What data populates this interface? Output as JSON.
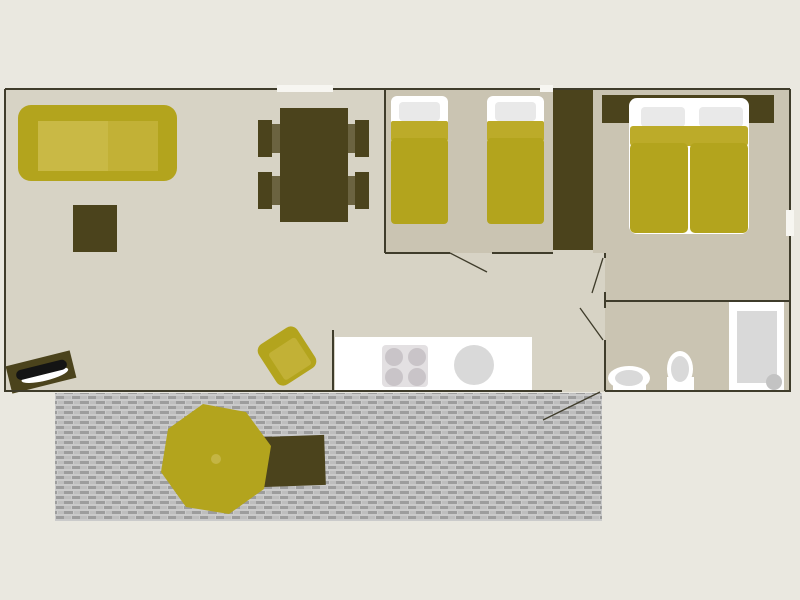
{
  "meta": {
    "title": "Mobile home floor plan (top view)",
    "style": "flat 2D architectural plan, no text labels visible"
  },
  "palette": {
    "bg": "#eae8e0",
    "floor_living": "#d7d3c5",
    "floor_room": "#cac4b2",
    "wall": "#3f3c2b",
    "olive": "#4b431c",
    "olive_seat": "#6b6340",
    "yellow": "#b3a41d",
    "yellow_light": "#c9b945",
    "yellow_mid": "#c2b136",
    "yellow_band": "#bcab29",
    "yellow_knob": "#c4b544",
    "white": "#ffffff",
    "gray_pillow": "#e9e9e9",
    "gray_fixture": "#d9d9d9",
    "gray_hob": "#e3e0e2",
    "gray_burner": "#c9c4c8",
    "gray_drain": "#c3c3c3",
    "window": "#f7f6f1",
    "screen": "#141414",
    "terrace_base": "#cbcbcb",
    "terrace_dark": "#9d9d9d",
    "terrace_mid": "#bebebe"
  },
  "rooms": {
    "living": "Living and dining area",
    "kitchen": "Kitchen corner",
    "twin_bedroom": "Bedroom with two single beds",
    "double_bedroom": "Bedroom with double bed",
    "bathroom": "Bathroom with shower, toilet and washbasin",
    "hallway": "Hallway",
    "terrace": "Decked terrace"
  },
  "furniture": {
    "sofa": "Sofa",
    "coffee_table": "Coffee table",
    "tv_unit": "TV unit",
    "dining_table": "Dining table",
    "dining_chair": "Dining chair",
    "armchair": "Armchair",
    "kitchen_counter": "Kitchen counter",
    "hob": "Four-burner hob",
    "kitchen_sink": "Round kitchen sink",
    "single_bed_1": "Single bed 1",
    "single_bed_2": "Single bed 2",
    "wardrobe": "Wardrobe",
    "double_bed": "Double bed",
    "headboard": "Headboard shelf",
    "washbasin": "Washbasin",
    "toilet": "Toilet",
    "shower": "Shower tray",
    "parasol": "Parasol",
    "garden_table": "Garden table"
  },
  "openings": {
    "window_top": "Window in top wall",
    "window_small_top": "Small window in top wall",
    "window_right": "Window in right wall",
    "door_twin_bedroom": "Twin bedroom door",
    "door_double_bedroom": "Double bedroom door",
    "door_bathroom": "Bathroom door",
    "door_entrance": "Entrance door to terrace"
  },
  "counts": {
    "windows": 3,
    "doors": 4,
    "beds": 3,
    "dining_chairs": 4
  }
}
